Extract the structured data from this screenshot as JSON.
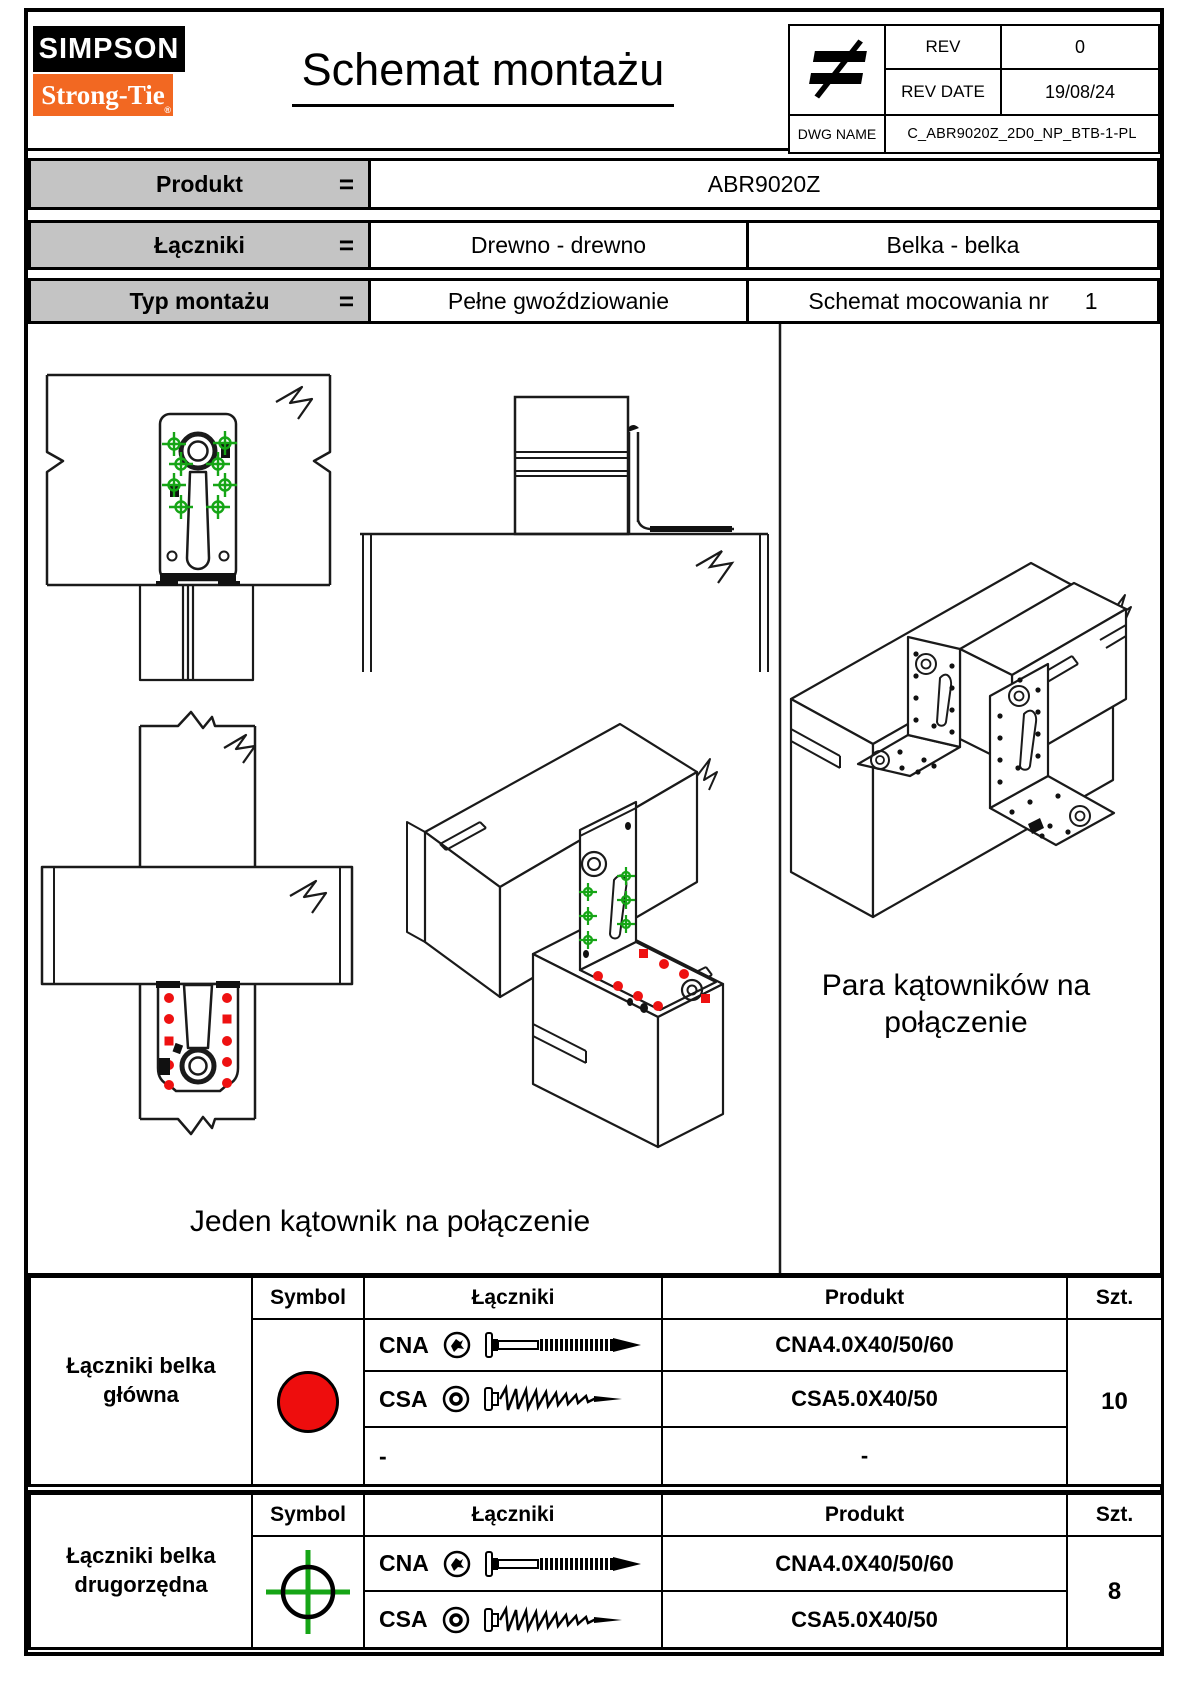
{
  "header": {
    "logo": {
      "top": "SIMPSON",
      "bottom": "Strong-Tie",
      "registered": "®"
    },
    "title": "Schemat montażu",
    "info": {
      "rev_label": "REV",
      "rev_value": "0",
      "rev_date_label": "REV DATE",
      "rev_date_value": "19/08/24",
      "dwg_label": "DWG NAME",
      "dwg_value": "C_ABR9020Z_2D0_NP_BTB-1-PL"
    }
  },
  "product_table": {
    "eq": "=",
    "produkt_label": "Produkt",
    "produkt_value": "ABR9020Z",
    "laczniki_label": "Łączniki",
    "laczniki_value_1": "Drewno - drewno",
    "laczniki_value_2": "Belka - belka",
    "typ_label": "Typ montażu",
    "typ_value_1": "Pełne gwoździowanie",
    "typ_value_2": "Schemat mocowania nr",
    "typ_value_2_num": "1"
  },
  "drawings": {
    "left_caption": "Jeden kątownik na połączenie",
    "right_caption": "Para kątowników na połączenie"
  },
  "fastener_table_1": {
    "label": "Łączniki belka główna",
    "headers": {
      "symbol": "Symbol",
      "laczniki": "Łączniki",
      "produkt": "Produkt",
      "qty": "Szt."
    },
    "rows": [
      {
        "code": "CNA",
        "produkt": "CNA4.0X40/50/60"
      },
      {
        "code": "CSA",
        "produkt": "CSA5.0X40/50"
      },
      {
        "code": "-",
        "produkt": "-"
      }
    ],
    "qty": "10",
    "symbol": "red-filled-circle"
  },
  "fastener_table_2": {
    "label": "Łączniki belka drugorzędna",
    "headers": {
      "symbol": "Symbol",
      "laczniki": "Łączniki",
      "produkt": "Produkt",
      "qty": "Szt."
    },
    "rows": [
      {
        "code": "CNA",
        "produkt": "CNA4.0X40/50/60"
      },
      {
        "code": "CSA",
        "produkt": "CSA5.0X40/50"
      }
    ],
    "qty": "8",
    "symbol": "green-crosshair-circle"
  },
  "colors": {
    "brand_orange": "#f26822",
    "symbol_red": "#ee0d0d",
    "marker_green": "#16a516",
    "table_grey": "#c4c4c4"
  }
}
